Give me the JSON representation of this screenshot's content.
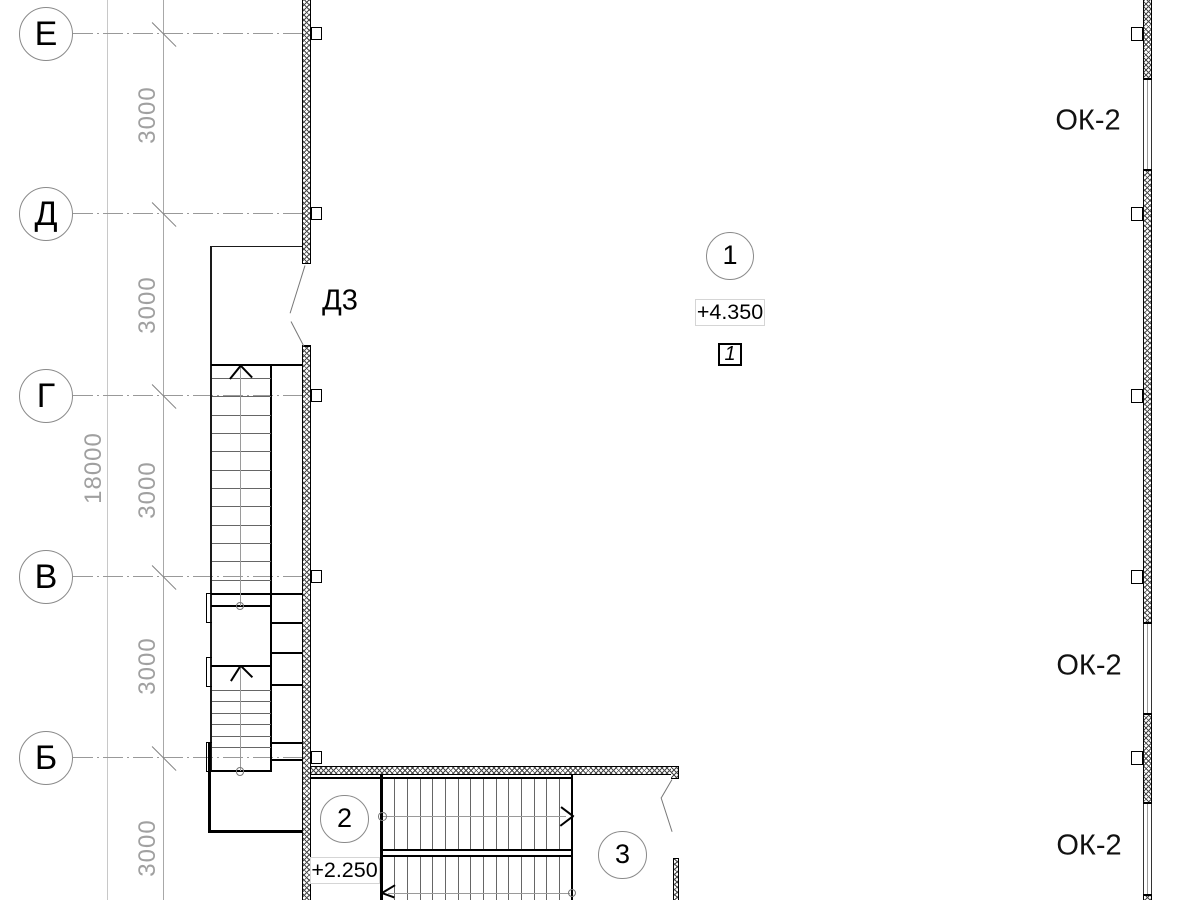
{
  "axes": [
    {
      "label": "Е",
      "y": 33.5
    },
    {
      "label": "Д",
      "y": 213.5
    },
    {
      "label": "Г",
      "y": 395.5
    },
    {
      "label": "В",
      "y": 576.5
    },
    {
      "label": "Б",
      "y": 757.5
    }
  ],
  "dimensions": {
    "segments": [
      {
        "label": "3000",
        "x": 148,
        "y": 115
      },
      {
        "label": "3000",
        "x": 148,
        "y": 305
      },
      {
        "label": "3000",
        "x": 148,
        "y": 490
      },
      {
        "label": "3000",
        "x": 148,
        "y": 666
      },
      {
        "label": "3000",
        "x": 148,
        "y": 848
      }
    ],
    "overall": {
      "label": "18000",
      "x": 94,
      "y": 468
    }
  },
  "door_tag": {
    "text": "Д3",
    "x": 340,
    "y": 301
  },
  "window_tags": [
    {
      "text": "ОК-2",
      "x": 1088,
      "y": 121
    },
    {
      "text": "ОК-2",
      "x": 1089,
      "y": 666
    },
    {
      "text": "ОК-2",
      "x": 1089,
      "y": 846
    }
  ],
  "room_marks": [
    {
      "text": "1",
      "x": 730,
      "y": 256
    },
    {
      "text": "2",
      "x": 344.5,
      "y": 819
    },
    {
      "text": "3",
      "x": 622.5,
      "y": 855
    }
  ],
  "elevation_marks": [
    {
      "text": "+4.350",
      "x": 730,
      "y": 312
    },
    {
      "text": "+2.250",
      "x": 344.5,
      "y": 870.5
    }
  ],
  "detail_mark": {
    "text": "1",
    "x": 730,
    "y": 354
  },
  "colors": {
    "ink": "#000000",
    "tread": "#666666",
    "axis_line": "#999999",
    "dim_text": "#a0a0a0",
    "leader": "#777777"
  }
}
